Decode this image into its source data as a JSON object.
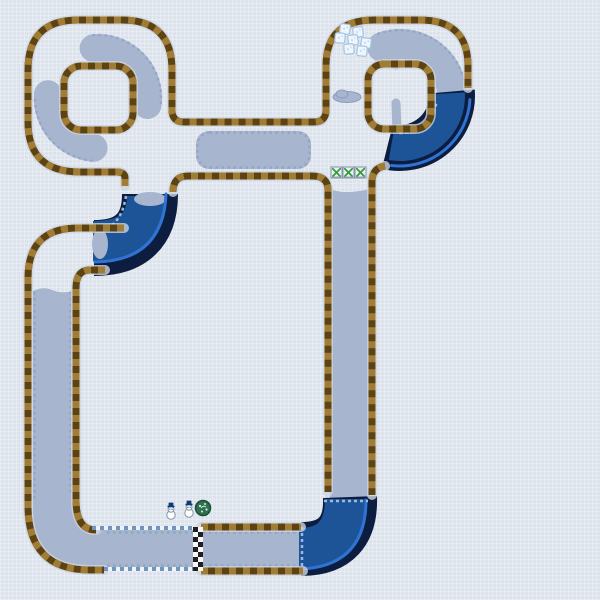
{
  "meta": {
    "screen": "kart-track-map",
    "theme": "snow-ice",
    "visible_text": "none"
  },
  "map": {
    "loops": 2,
    "islands": 2,
    "water_sections": [
      {
        "name": "right-loop-bend"
      },
      {
        "name": "upper-left-elbow"
      },
      {
        "name": "bottom-right-corner"
      }
    ],
    "finish_line": {
      "columns": 2,
      "rows": 9,
      "cell_px": 5
    },
    "colors": {
      "bg": "#dce3ed",
      "surface": "#a7b5cf",
      "surface-edge": "#8da0c0",
      "border-dark": "#5e4312",
      "border-light": "#a07c35",
      "border-halo": "#ccd4e0",
      "water-edge": "#0d1d40",
      "water-fill": "#1d5397",
      "water-line": "#2f74d3",
      "water-dash": "#9db9dc",
      "icedash-blue": "#6e96bf",
      "icedash-white": "#eef3f8",
      "finish-dark": "#202020",
      "finish-light": "#f8f8f8",
      "ice-fill": "#eef5fc",
      "ice-stroke": "#a3c3e0",
      "ice-speck": "#c9dced",
      "panel-bg": "#e9eff5",
      "panel-border": "#8494a4",
      "panel-green": "#379a41",
      "tree-fill": "#2f7050",
      "tree-stroke": "#1c4f38",
      "tree-speck": "#d9ebdd",
      "snow-white": "#fdfeff",
      "snow-stroke": "#8595ab",
      "hat": "#0e3a78",
      "eye": "#3a3a46"
    },
    "sprites": {
      "ice_blocks": {
        "count": 7,
        "size": 10,
        "positions": [
          [
            345,
            29,
            8
          ],
          [
            358,
            32,
            -7
          ],
          [
            340,
            38,
            5
          ],
          [
            353,
            40,
            -8
          ],
          [
            366,
            43,
            7
          ],
          [
            349,
            49,
            -5
          ],
          [
            362,
            51,
            6
          ]
        ]
      },
      "item_panels": {
        "count": 3,
        "size": 11,
        "y": 167,
        "xs": [
          331,
          343,
          355
        ]
      },
      "snowmen": {
        "count": 2,
        "positions": [
          [
            171,
            505
          ],
          [
            189,
            503
          ]
        ]
      },
      "tree": {
        "count": 1,
        "position": [
          203,
          508
        ]
      }
    }
  }
}
